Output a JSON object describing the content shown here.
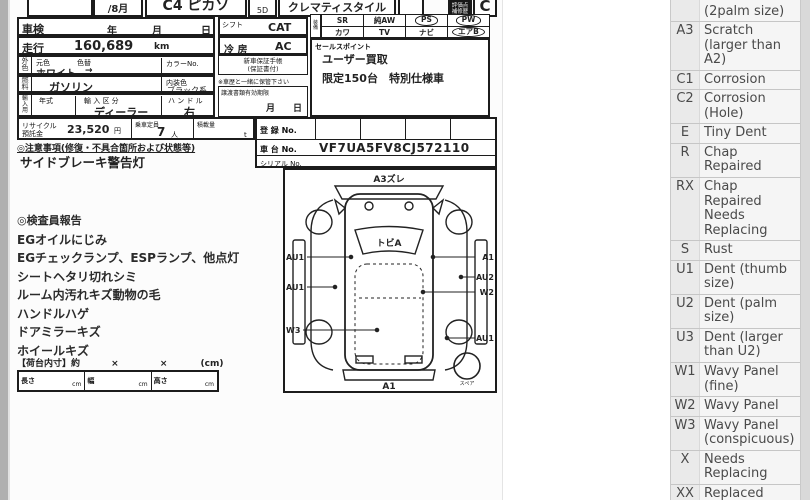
{
  "header": {
    "month": "/8月",
    "model": "C4 ピカソ",
    "doors": "5D",
    "grade": "クレマティスタイル",
    "score_box_label": "評価点\n補修歴",
    "score": "C"
  },
  "info": {
    "shaken": {
      "label": "車検",
      "year": "年",
      "month": "月",
      "day": "日"
    },
    "mileage": {
      "label": "走行",
      "value": "160,689",
      "unit": "km"
    },
    "color": {
      "label": "外\n色",
      "base": "元色",
      "change": "色替",
      "no": "カラーNo.",
      "value": "ホワイト",
      "arrow": "→"
    },
    "fuel": {
      "label": "燃\n料",
      "value": "ガソリン",
      "interior_label": "内装色",
      "interior": "ブラック系"
    },
    "import": {
      "label": "輸\n入\n用",
      "year": "年式",
      "class_label": "輸 入 区 分",
      "class_value": "ディーラー",
      "handle_label": "ハ ン ド ル",
      "handle_value": "右"
    },
    "recycle": {
      "label": "リサイクル\n預託金",
      "value": "23,520",
      "unit": "円",
      "cap_label": "乗車定員",
      "cap_value": "7",
      "cap_unit": "人",
      "load_label": "積載量",
      "load_unit": "t"
    },
    "shift": {
      "label": "シフト",
      "value": "CAT"
    },
    "aircon": {
      "label": "冷 房",
      "value": "AC"
    },
    "warranty": "新車保証手帳\n(保証書付)",
    "keep_note": "※車歴と一緒に保管下さい",
    "transfer": {
      "label": "譲渡書類有効期限",
      "value": "月　　日"
    },
    "reg": {
      "label": "登 録 No."
    },
    "chassis": {
      "label": "車 台 No.",
      "value": "VF7UA5FV8CJ572110"
    },
    "serial": {
      "label": "シリアル No."
    }
  },
  "equipment": {
    "label": "装備",
    "rows": [
      [
        "SR",
        "純AW",
        "PS",
        "PW"
      ],
      [
        "カワ",
        "TV",
        "ナビ",
        "エアB"
      ]
    ],
    "circled": [
      "PS",
      "PW",
      "エアB"
    ]
  },
  "sales": {
    "label": "セールスポイント",
    "lines": [
      "ユーザー買取",
      "限定150台　特別仕様車"
    ]
  },
  "notes": {
    "title": "◎注意事項(修復・不具合箇所および状態等)",
    "line": "サイドブレーキ警告灯"
  },
  "inspector": {
    "title": "◎検査員報告",
    "lines": [
      "EGオイルにじみ",
      "EGチェックランプ、ESPランプ、他点灯",
      "シートヘタリ切れシミ",
      "ルーム内汚れキズ動物の毛",
      "ハンドルハゲ",
      "ドアミラーキズ",
      "ホイールキズ"
    ]
  },
  "cargo": {
    "title": "【荷台内寸】約",
    "x1": "×",
    "x2": "×",
    "cm": "(cm)",
    "cells": [
      {
        "label": "長さ",
        "unit": "cm"
      },
      {
        "label": "幅",
        "unit": "cm"
      },
      {
        "label": "高さ",
        "unit": "cm"
      }
    ]
  },
  "diagram": {
    "front": "A3ズレ",
    "windshield": "トビA",
    "left": [
      "AU1",
      "AU1",
      "W3"
    ],
    "right": [
      "A1",
      "AU2",
      "W2",
      "AU1"
    ],
    "bottom": "A1",
    "spare": "スペア"
  },
  "legend": {
    "rows": [
      {
        "code": "A2",
        "desc": "Scratch\n(2palm size)"
      },
      {
        "code": "A3",
        "desc": "Scratch\n(larger than\nA2)"
      },
      {
        "code": "C1",
        "desc": "Corrosion"
      },
      {
        "code": "C2",
        "desc": "Corrosion\n(Hole)"
      },
      {
        "code": "E",
        "desc": "Tiny Dent"
      },
      {
        "code": "R",
        "desc": "Chap\nRepaired"
      },
      {
        "code": "RX",
        "desc": "Chap\nRepaired\nNeeds\nReplacing"
      },
      {
        "code": "S",
        "desc": "Rust"
      },
      {
        "code": "U1",
        "desc": "Dent (thumb\nsize)"
      },
      {
        "code": "U2",
        "desc": "Dent (palm\nsize)"
      },
      {
        "code": "U3",
        "desc": "Dent (larger\nthan U2)"
      },
      {
        "code": "W1",
        "desc": "Wavy Panel\n(fine)"
      },
      {
        "code": "W2",
        "desc": "Wavy Panel"
      },
      {
        "code": "W3",
        "desc": "Wavy Panel\n(conspicuous)"
      },
      {
        "code": "X",
        "desc": "Needs\nReplacing"
      },
      {
        "code": "XX",
        "desc": "Replaced"
      },
      {
        "code": "Y1",
        "desc": "Hole? Crack"
      }
    ]
  }
}
